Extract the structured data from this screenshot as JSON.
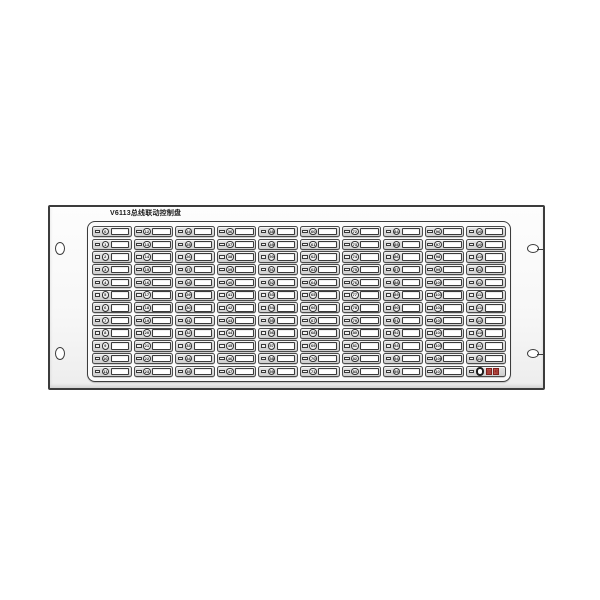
{
  "window": {
    "background_color": "#ffffff"
  },
  "panel": {
    "title": "V6113总线联动控制盘",
    "type": "bus-linkage-control-panel",
    "colors": {
      "outline": "#3c3c3c",
      "cell_background": "#d6d6d6",
      "window_background": "#ffffff",
      "special_tag_red": "#c4524a"
    },
    "grid": {
      "columns": 10,
      "rows": 12,
      "order": "column-major",
      "unit_parts": [
        "led-indicator",
        "numbered-round-button",
        "blank-label-window"
      ]
    },
    "button_numbers": [
      0,
      1,
      2,
      3,
      4,
      5,
      6,
      7,
      8,
      9,
      10,
      11,
      12,
      13,
      14,
      15,
      16,
      17,
      18,
      19,
      20,
      21,
      22,
      23,
      24,
      25,
      26,
      27,
      28,
      29,
      30,
      31,
      32,
      33,
      34,
      35,
      36,
      37,
      38,
      39,
      40,
      41,
      42,
      43,
      44,
      45,
      46,
      47,
      48,
      49,
      50,
      51,
      52,
      53,
      54,
      55,
      56,
      57,
      58,
      59,
      60,
      61,
      62,
      63,
      64,
      65,
      66,
      67,
      68,
      69,
      70,
      71,
      72,
      73,
      74,
      75,
      76,
      77,
      78,
      79,
      80,
      81,
      82,
      83,
      84,
      85,
      86,
      87,
      88,
      89,
      90,
      91,
      92,
      93,
      94,
      95,
      96,
      97,
      98,
      99,
      100,
      101,
      102,
      103,
      104,
      105,
      106,
      107,
      108,
      109,
      110,
      111,
      112,
      113,
      114,
      115,
      116,
      117,
      118
    ],
    "special_button": {
      "position": "bottom-right",
      "tags": [
        "自",
        "检"
      ]
    },
    "screw_slots": {
      "count": 4,
      "positions": [
        "left-top",
        "left-bottom",
        "right-top",
        "right-bottom"
      ]
    }
  }
}
